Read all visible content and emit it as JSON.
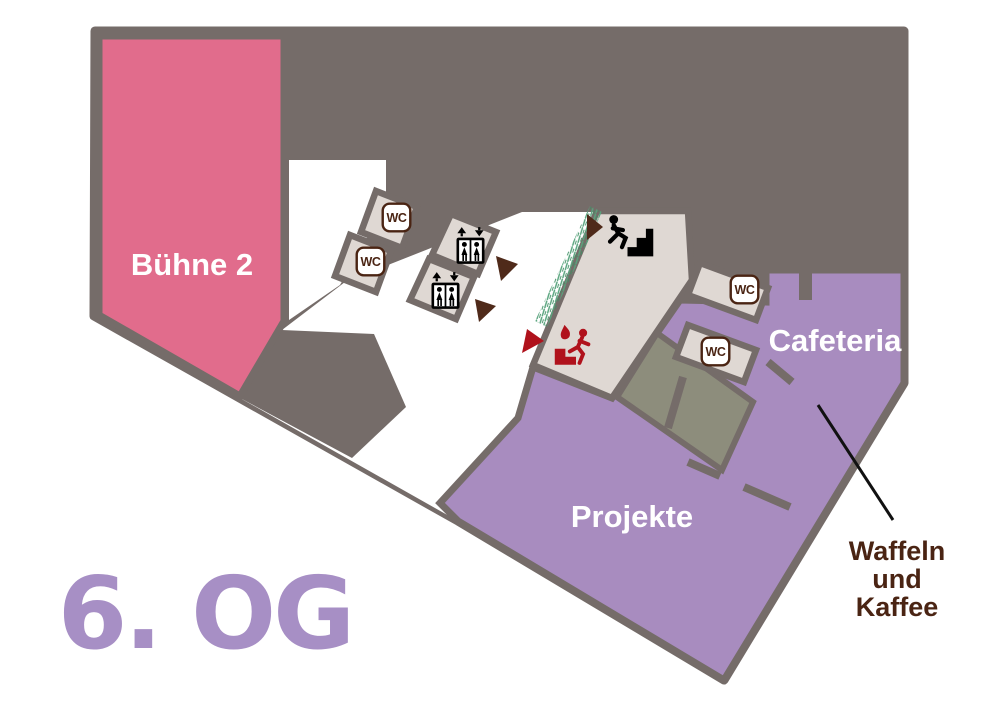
{
  "floor": {
    "label": "6. OG"
  },
  "rooms": {
    "stage": {
      "label": "Bühne 2",
      "color": "#E16C8C"
    },
    "projects": {
      "label": "Projekte",
      "color": "#A88CBF"
    },
    "cafeteria": {
      "label": "Cafeteria",
      "color": "#A88CBF"
    }
  },
  "facilities": {
    "wc_label": "WC"
  },
  "annotation": {
    "line1": "Waffeln",
    "line2": "und",
    "line3": "Kaffee",
    "color": "#4A2413",
    "points_to": "Cafeteria"
  },
  "icons": {
    "wc": "wc-icon",
    "elevator": "elevator-icon",
    "stairs": "stairs-icon",
    "emergency_exit": "emergency-exit-icon",
    "direction_arrow": "direction-arrow-icon",
    "greenery": "greenery-hatch"
  },
  "colors": {
    "background": "#FFFFFF",
    "walls": "#756C69",
    "room_beige": "#DFD8D3",
    "room_olive": "#8D8D7C",
    "accent_red": "#B0121C",
    "icon_brown": "#4A2413",
    "arrow_brown": "#4F2A1A",
    "greenery": "#5FA57E",
    "floor_text": "#A78FC5"
  }
}
